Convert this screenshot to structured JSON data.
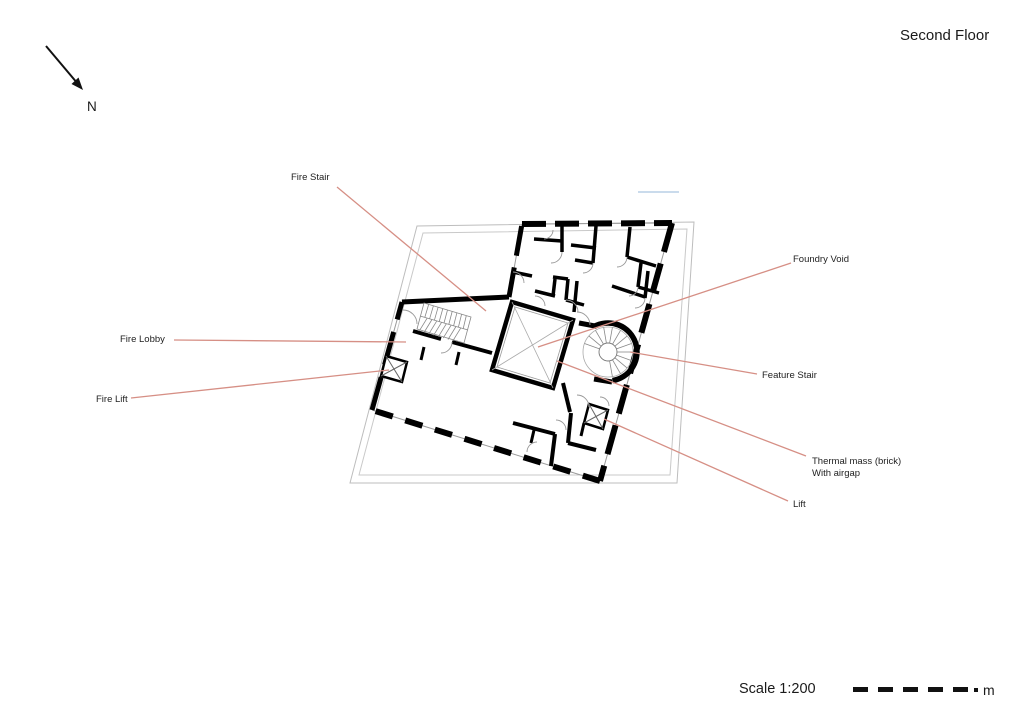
{
  "title": "Second Floor",
  "north": {
    "label": "N"
  },
  "annotations": [
    {
      "id": "fire-stair",
      "label": "Fire Stair"
    },
    {
      "id": "fire-lobby",
      "label": "Fire Lobby"
    },
    {
      "id": "fire-lift",
      "label": "Fire Lift"
    },
    {
      "id": "foundry-void",
      "label": "Foundry Void"
    },
    {
      "id": "feature-stair",
      "label": "Feature Stair"
    },
    {
      "id": "thermal-mass",
      "label": "Thermal mass (brick)",
      "label_line2": "With airgap"
    },
    {
      "id": "lift",
      "label": "Lift"
    }
  ],
  "scale": {
    "label": "Scale 1:200",
    "unit": "m",
    "bar_segments": 5
  },
  "colors": {
    "leader_line": "#d68f85",
    "wall": "#000000",
    "site_outline": "#bdbdbd",
    "glazing_line": "#9a9a9a",
    "reference_line_blue": "#b9cfe6",
    "text": "#1f1f1f"
  }
}
